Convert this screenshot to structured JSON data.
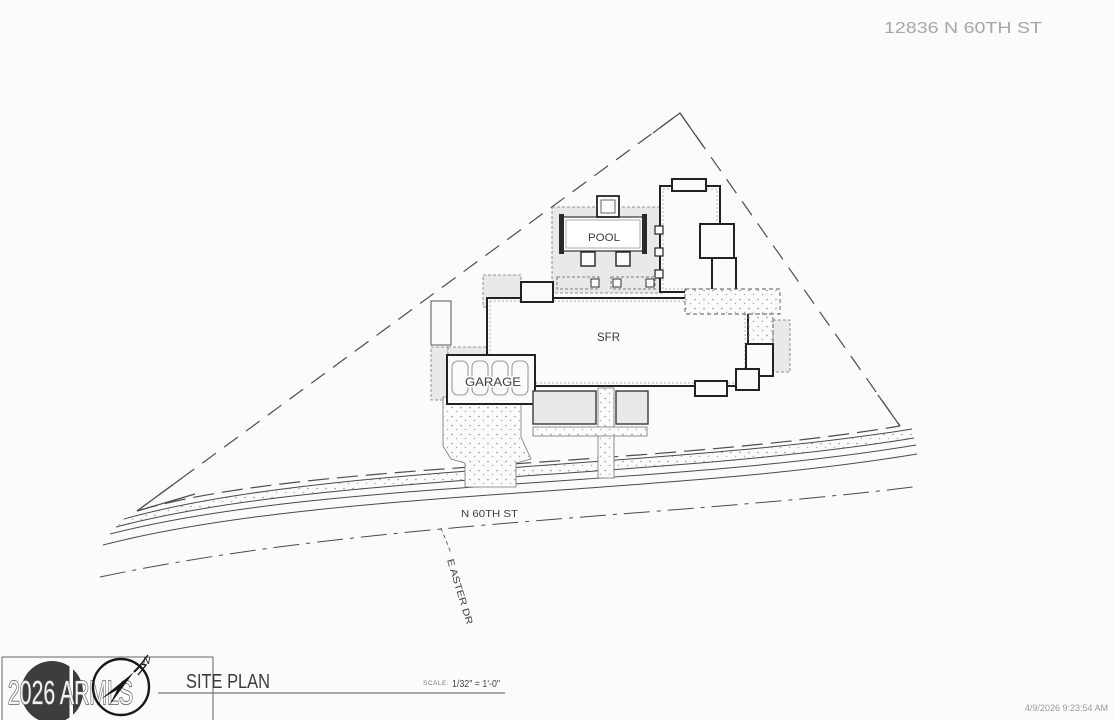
{
  "header": {
    "address": "12836 N 60TH ST"
  },
  "drawing": {
    "labels": {
      "pool": "POOL",
      "residence": "SFR",
      "garage": "GARAGE",
      "main_street": "N 60TH ST",
      "side_street": "E ASTER DR"
    }
  },
  "title_block": {
    "title": "SITE PLAN",
    "scale_label": "SCALE:",
    "scale_value": "1/32\" = 1'-0\"",
    "north_arrow_label": "N",
    "watermark": "2026 ARMLS"
  },
  "footer": {
    "timestamp": "4/9/2026 9:23:54 AM"
  },
  "colors": {
    "background": "#fbfbfa",
    "wall_line": "#222222",
    "thin_line": "#4a4a4a",
    "shading": "#e9e9e7",
    "muted_text": "#a6a6a6",
    "watermark_circle": "#3d3d3d"
  }
}
